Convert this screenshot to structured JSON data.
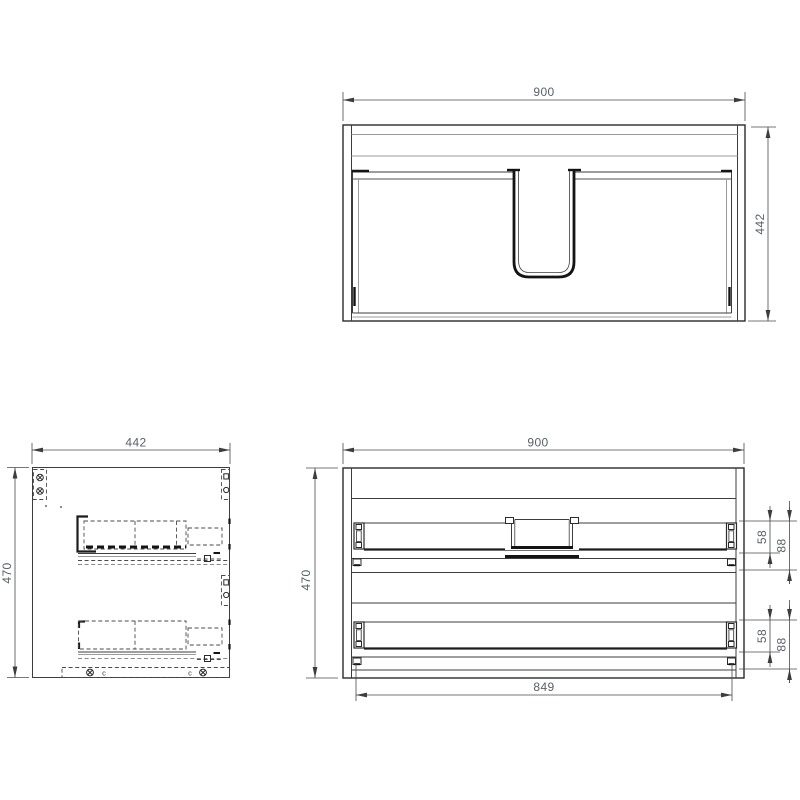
{
  "views": {
    "top": {
      "title": "top-view-plan",
      "dim_width": "900",
      "dim_depth": "442"
    },
    "side": {
      "title": "side-view-section",
      "dim_width": "442",
      "dim_height": "470",
      "bottom_labels": {
        "left": "c",
        "right": "c"
      }
    },
    "front": {
      "title": "rear-elevation",
      "dim_width": "900",
      "dim_height": "470",
      "dim_slide_span": "849",
      "upper": {
        "dim_slide_height": "58",
        "dim_overall_height": "88"
      },
      "lower": {
        "dim_slide_height": "58",
        "dim_overall_height": "88"
      }
    }
  },
  "colors": {
    "background": "#ffffff",
    "line": "#3d3d3d",
    "line_dark": "#141414",
    "line_light": "#9b9b9b",
    "dim_text": "#596069"
  }
}
